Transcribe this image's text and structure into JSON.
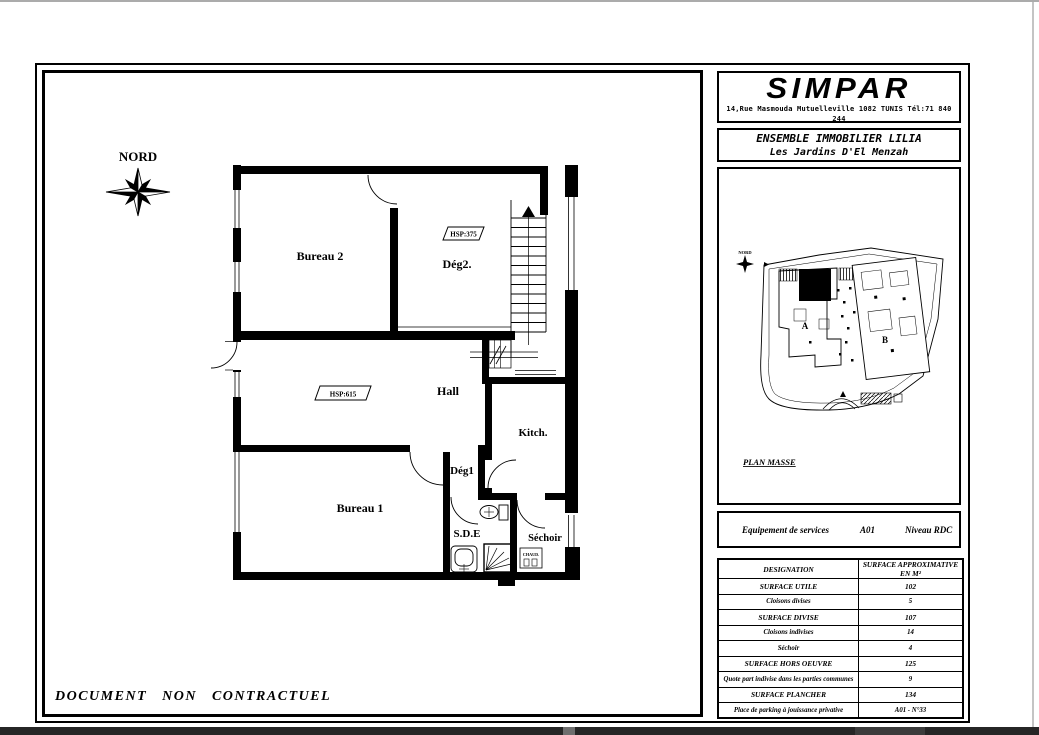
{
  "header": {
    "logo": "SIMPAR",
    "address": "14,Rue Masmouda Mutuelleville 1082 TUNIS Tél:71 840 244"
  },
  "project": {
    "title": "ENSEMBLE IMMOBILIER LILIA",
    "subtitle": "Les Jardins D'El Menzah"
  },
  "site_plan": {
    "caption": "PLAN MASSE",
    "north_label": "NORD",
    "building_a_label": "A",
    "building_b_label": "B"
  },
  "equipment": {
    "label": "Equipement de services",
    "unit": "A01",
    "level": "Niveau RDC"
  },
  "surface_table": {
    "header": {
      "designation": "DESIGNATION",
      "surface": "SURFACE APPROXIMATIVE EN M²"
    },
    "rows": [
      {
        "designation": "SURFACE UTILE",
        "value": "102"
      },
      {
        "designation": "Cloisons divises",
        "value": "5"
      },
      {
        "designation": "SURFACE DIVISE",
        "value": "107"
      },
      {
        "designation": "Cloisons indivises",
        "value": "14"
      },
      {
        "designation": "Séchoir",
        "value": "4"
      },
      {
        "designation": "SURFACE HORS OEUVRE",
        "value": "125"
      },
      {
        "designation": "Quote part indivise dans les parties communes",
        "value": "9"
      },
      {
        "designation": "SURFACE PLANCHER",
        "value": "134"
      },
      {
        "designation": "Place de parking à jouissance privative",
        "value": "A01 - N°33"
      }
    ]
  },
  "floor_plan": {
    "north_label": "NORD",
    "rooms": {
      "bureau2": "Bureau 2",
      "deg2": "Dég2.",
      "hall": "Hall",
      "kitchen": "Kitch.",
      "deg1": "Dég1",
      "bureau1": "Bureau 1",
      "sde": "S.D.E",
      "sechoir": "Séchoir",
      "chaud": "CHAUD."
    },
    "tags": {
      "deg2_hsp": "HSP:375",
      "hall_hsp": "HSP:615"
    }
  },
  "footer": {
    "disclaimer": "DOCUMENT NON CONTRACTUEL"
  }
}
